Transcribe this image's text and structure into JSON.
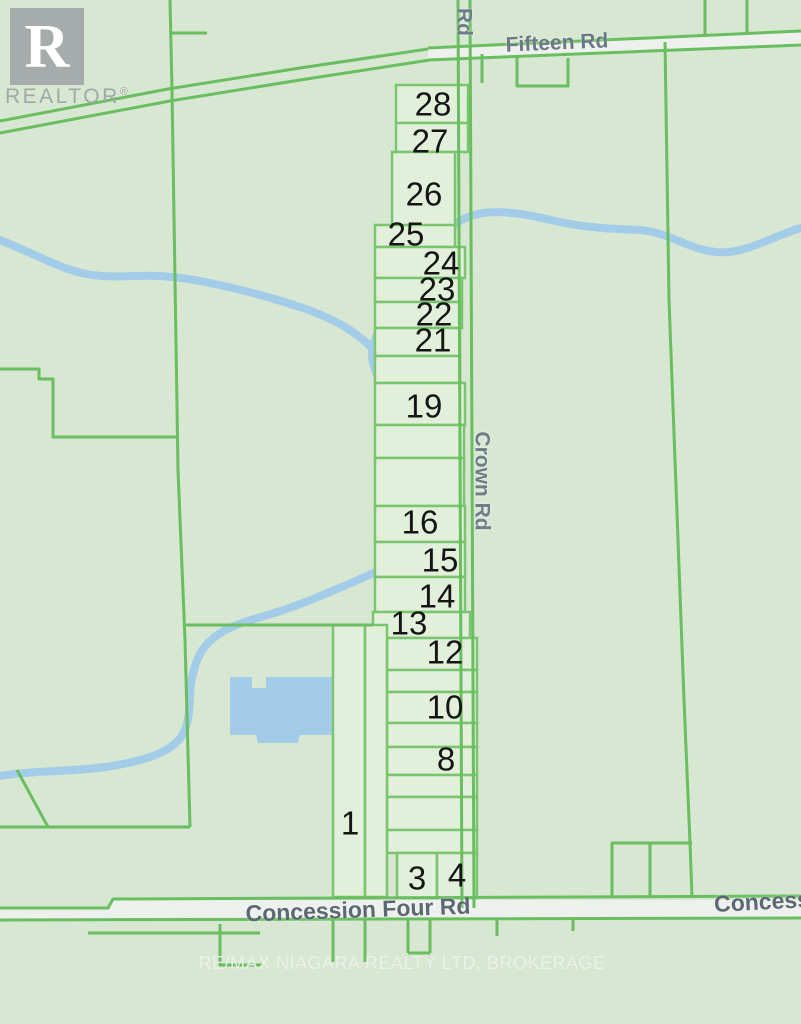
{
  "map": {
    "roads": {
      "fifteen_rd": "Fifteen Rd",
      "crown_rd": "Crown Rd",
      "crown_rd_partial": "Rd",
      "concession_four_rd": "Concession Four Rd",
      "concession_partial": "Concess"
    },
    "parcels": [
      {
        "label": "28"
      },
      {
        "label": "27"
      },
      {
        "label": "26"
      },
      {
        "label": "25"
      },
      {
        "label": "24"
      },
      {
        "label": "23"
      },
      {
        "label": "22"
      },
      {
        "label": "21"
      },
      {
        "label": "19"
      },
      {
        "label": "16"
      },
      {
        "label": "15"
      },
      {
        "label": "14"
      },
      {
        "label": "13"
      },
      {
        "label": "12"
      },
      {
        "label": "10"
      },
      {
        "label": "8"
      },
      {
        "label": "1"
      },
      {
        "label": "3"
      },
      {
        "label": "4"
      }
    ],
    "watermark": "RE/MAX NIAGARA REALTY LTD, BROKERAGE",
    "branding": {
      "logo_letter": "R",
      "logo_text": "REALTOR",
      "registered_mark": "®"
    },
    "colors": {
      "background": "#d7e7d2",
      "parcel_fill": "#e2efdb",
      "line_green": "#69be5f",
      "road_fill": "#edf0ec",
      "water": "#a3cce9",
      "road_label": "#6b7987",
      "parcel_number": "#151515",
      "logo_gray": "#a6abab"
    }
  }
}
